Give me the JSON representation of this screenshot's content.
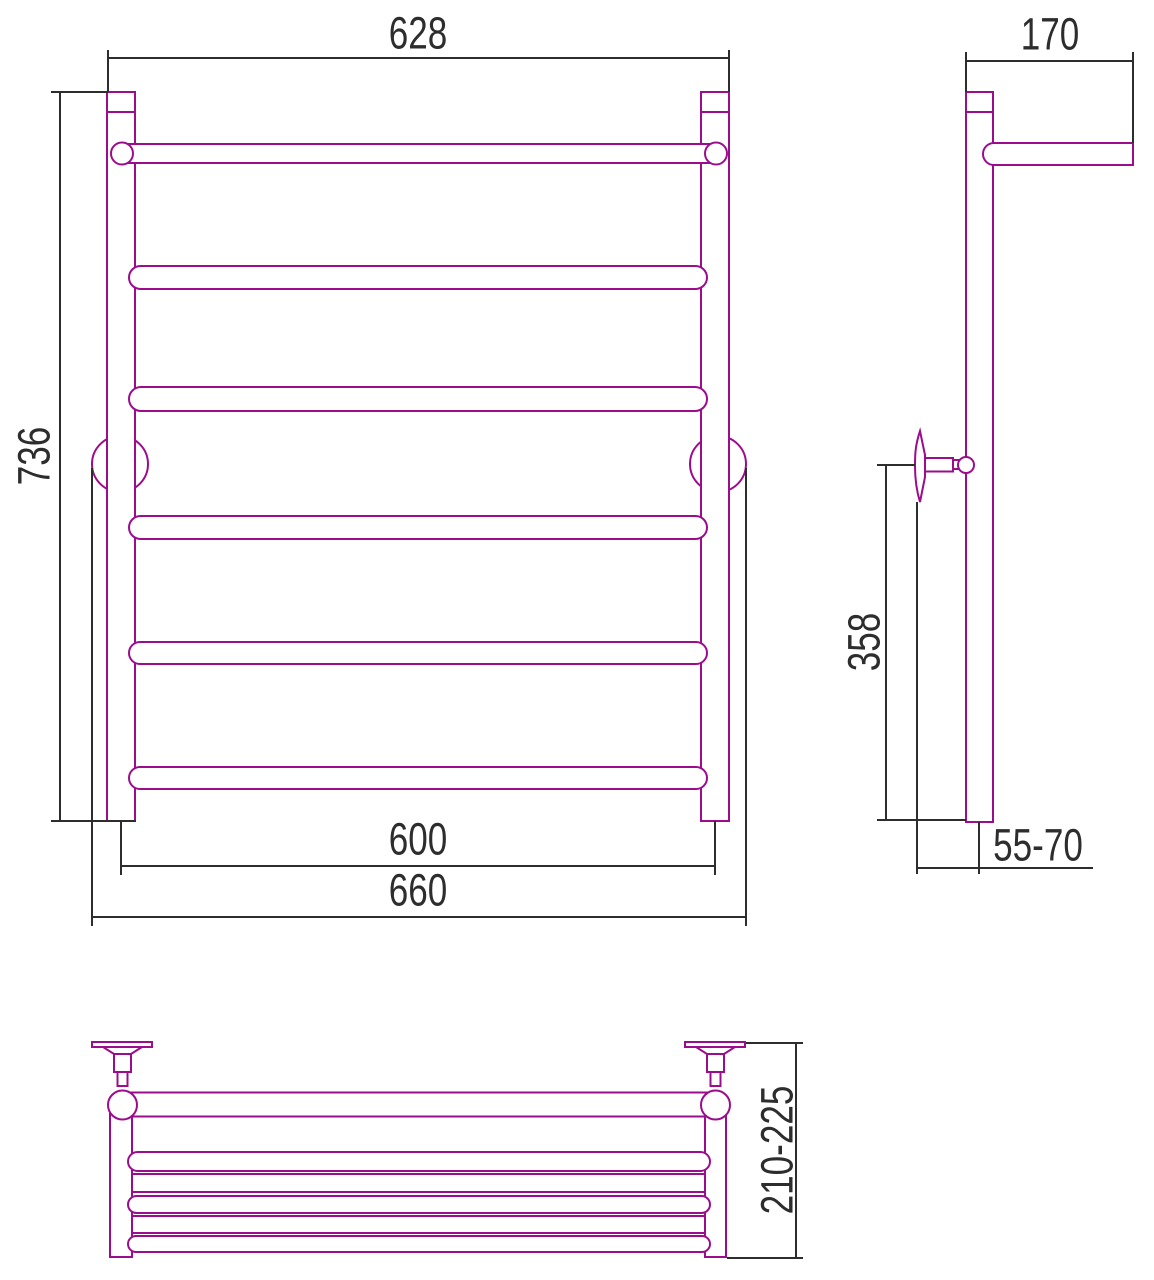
{
  "drawing": {
    "type": "technical-drawing",
    "views": {
      "front": {
        "dims": {
          "top_width": "628",
          "height": "736",
          "bottom_rail_width": "600",
          "bottom_overall_width": "660"
        }
      },
      "side": {
        "dims": {
          "shelf_depth": "170",
          "bracket_to_bottom_height": "358",
          "wall_offset": "55-70"
        }
      },
      "plan": {
        "dims": {
          "overall_depth": "210-225"
        }
      }
    },
    "colors": {
      "product_outline": "#9B0D8C",
      "dimension_lines": "#2D2D2D",
      "background": "#FFFFFF"
    }
  }
}
